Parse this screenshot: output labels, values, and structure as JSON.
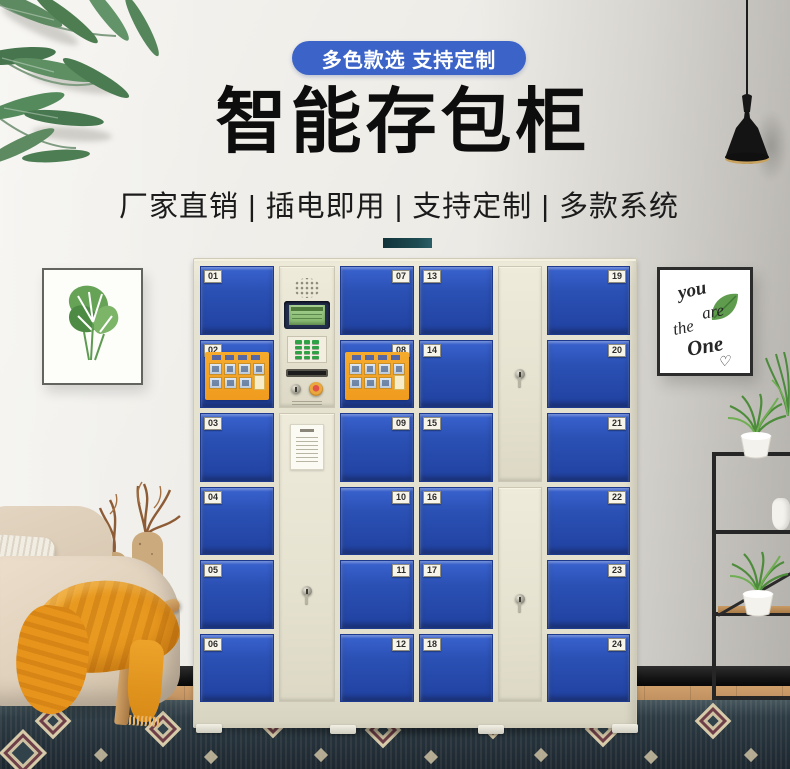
{
  "colors": {
    "badge_blue": "#3b63c8",
    "door_blue": "#2b51b5",
    "cabinet_cream": "#e8e4d3",
    "divider_teal": "#1d4b52",
    "sticker_orange": "#f09b1e",
    "throw_orange": "#e8991f"
  },
  "header": {
    "badge_label": "多色款选 支持定制",
    "title": "智能存包柜",
    "subtitle": "厂家直销 | 插电即用 | 支持定制 | 多款系统"
  },
  "locker": {
    "columns": [
      {
        "plate_side": "left",
        "doors": [
          "01",
          "02",
          "03",
          "04",
          "05",
          "06"
        ]
      },
      {
        "plate_side": "right",
        "doors": [
          "07",
          "08",
          "09",
          "10",
          "11",
          "12"
        ]
      },
      {
        "plate_side": "left",
        "doors": [
          "13",
          "14",
          "15",
          "16",
          "17",
          "18"
        ]
      },
      {
        "plate_side": "right",
        "doors": [
          "19",
          "20",
          "21",
          "22",
          "23",
          "24"
        ]
      }
    ],
    "stickered_doors": [
      "02",
      "08"
    ]
  },
  "wall_art": {
    "right_words": [
      "you",
      "are",
      "the",
      "One"
    ],
    "right_heart": "♡"
  }
}
